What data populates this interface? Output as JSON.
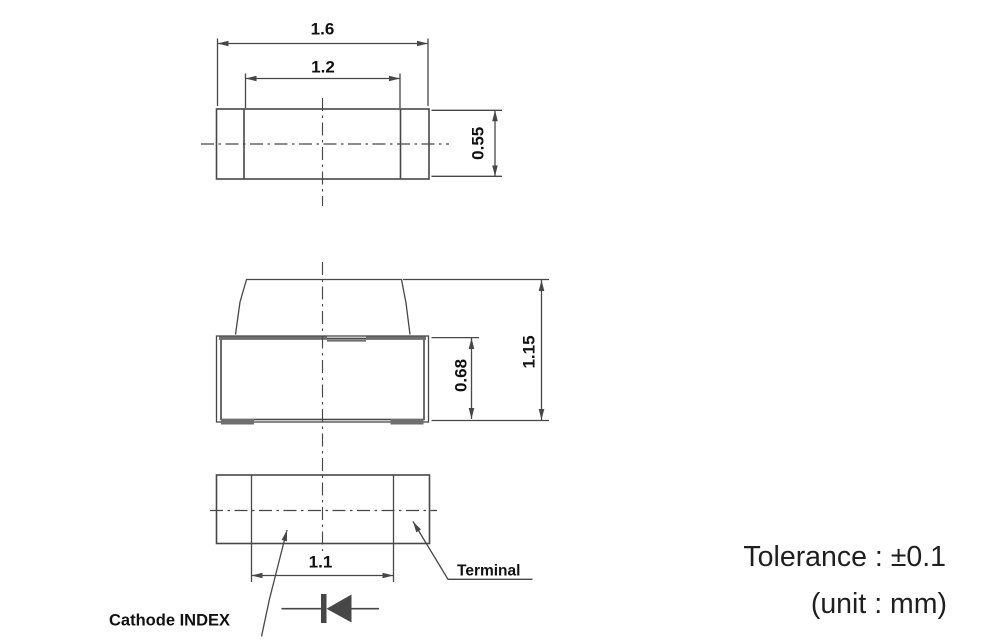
{
  "colors": {
    "line": "#474747",
    "thick": "#6e6e6e",
    "text": "#111111",
    "note_text": "#1f1f1f"
  },
  "dimensions": {
    "top_outer_width": "1.6",
    "top_inner_width": "1.2",
    "top_depth": "0.55",
    "side_body_height": "0.68",
    "side_total_height": "1.15",
    "bottom_terminal_span": "1.1"
  },
  "labels": {
    "terminal": "Terminal",
    "cathode_index": "Cathode INDEX"
  },
  "notes": {
    "tolerance": "Tolerance : ±0.1",
    "unit": "(unit : mm)"
  },
  "icons": {
    "diode_symbol": "diode with cathode bar at left and filled triangle pointing left"
  }
}
